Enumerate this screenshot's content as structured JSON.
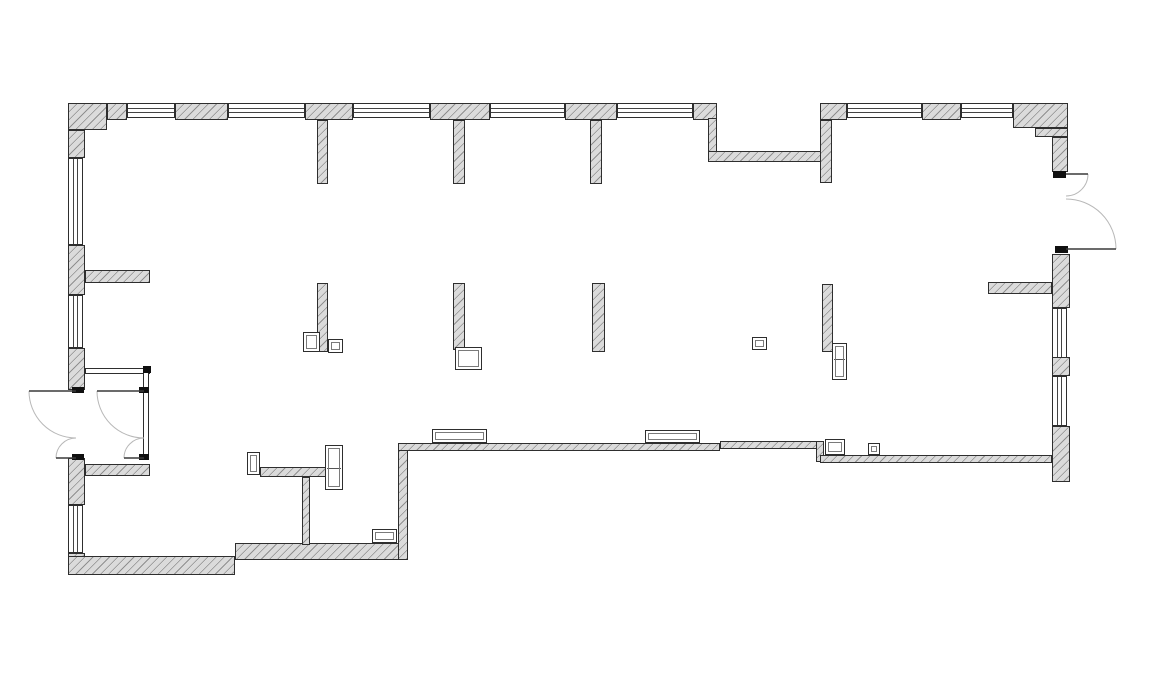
{
  "canvas": {
    "width": 1153,
    "height": 678,
    "background": "#ffffff"
  },
  "drawing_type": "architectural-floor-plan",
  "colors": {
    "background": "#ffffff",
    "wall_fill": "#dbdbdb",
    "wall_hatch": "#8f8f8f",
    "wall_outline": "#2e2e2e",
    "window_glass_line": "#444444",
    "door_swing_arc": "#b8b8b8",
    "door_leaf": "#3a3a3a",
    "door_hinge": "#101010"
  },
  "plan": {
    "walls": [
      {
        "x": 68,
        "y": 103,
        "w": 39,
        "h": 27
      },
      {
        "x": 68,
        "y": 130,
        "w": 17,
        "h": 28
      },
      {
        "x": 107,
        "y": 103,
        "w": 20,
        "h": 17
      },
      {
        "x": 175,
        "y": 103,
        "w": 53,
        "h": 17
      },
      {
        "x": 305,
        "y": 103,
        "w": 48,
        "h": 17
      },
      {
        "x": 317,
        "y": 120,
        "w": 11,
        "h": 64
      },
      {
        "x": 430,
        "y": 103,
        "w": 60,
        "h": 17
      },
      {
        "x": 453,
        "y": 120,
        "w": 12,
        "h": 64
      },
      {
        "x": 565,
        "y": 103,
        "w": 52,
        "h": 17
      },
      {
        "x": 590,
        "y": 120,
        "w": 12,
        "h": 64
      },
      {
        "x": 693,
        "y": 103,
        "w": 24,
        "h": 17
      },
      {
        "x": 708,
        "y": 118,
        "w": 9,
        "h": 40
      },
      {
        "x": 708,
        "y": 151,
        "w": 114,
        "h": 11
      },
      {
        "x": 820,
        "y": 103,
        "w": 27,
        "h": 17
      },
      {
        "x": 820,
        "y": 120,
        "w": 12,
        "h": 63
      },
      {
        "x": 922,
        "y": 103,
        "w": 39,
        "h": 17
      },
      {
        "x": 1013,
        "y": 103,
        "w": 55,
        "h": 25
      },
      {
        "x": 1035,
        "y": 128,
        "w": 33,
        "h": 9
      },
      {
        "x": 1052,
        "y": 137,
        "w": 16,
        "h": 35
      },
      {
        "x": 1052,
        "y": 254,
        "w": 18,
        "h": 54
      },
      {
        "x": 988,
        "y": 282,
        "w": 64,
        "h": 12
      },
      {
        "x": 1052,
        "y": 357,
        "w": 18,
        "h": 19
      },
      {
        "x": 1052,
        "y": 426,
        "w": 18,
        "h": 56
      },
      {
        "x": 68,
        "y": 245,
        "w": 17,
        "h": 50
      },
      {
        "x": 85,
        "y": 270,
        "w": 65,
        "h": 13
      },
      {
        "x": 68,
        "y": 348,
        "w": 17,
        "h": 42
      },
      {
        "x": 68,
        "y": 458,
        "w": 17,
        "h": 47
      },
      {
        "x": 85,
        "y": 464,
        "w": 65,
        "h": 12
      },
      {
        "x": 68,
        "y": 553,
        "w": 17,
        "h": 22
      },
      {
        "x": 68,
        "y": 556,
        "w": 167,
        "h": 19
      },
      {
        "x": 235,
        "y": 543,
        "w": 165,
        "h": 17
      },
      {
        "x": 398,
        "y": 443,
        "w": 10,
        "h": 117
      },
      {
        "x": 398,
        "y": 443,
        "w": 322,
        "h": 8
      },
      {
        "x": 720,
        "y": 441,
        "w": 98,
        "h": 8
      },
      {
        "x": 816,
        "y": 441,
        "w": 8,
        "h": 21
      },
      {
        "x": 820,
        "y": 455,
        "w": 232,
        "h": 8
      },
      {
        "x": 302,
        "y": 477,
        "w": 8,
        "h": 68
      },
      {
        "x": 260,
        "y": 467,
        "w": 70,
        "h": 10
      },
      {
        "x": 317,
        "y": 283,
        "w": 11,
        "h": 69
      },
      {
        "x": 453,
        "y": 283,
        "w": 12,
        "h": 67
      },
      {
        "x": 592,
        "y": 283,
        "w": 13,
        "h": 69
      },
      {
        "x": 822,
        "y": 284,
        "w": 11,
        "h": 68
      }
    ],
    "windows": [
      {
        "x": 127,
        "y": 103,
        "w": 48,
        "h": 15,
        "o": "h"
      },
      {
        "x": 228,
        "y": 103,
        "w": 77,
        "h": 15,
        "o": "h"
      },
      {
        "x": 353,
        "y": 103,
        "w": 77,
        "h": 15,
        "o": "h"
      },
      {
        "x": 490,
        "y": 103,
        "w": 75,
        "h": 15,
        "o": "h"
      },
      {
        "x": 617,
        "y": 103,
        "w": 76,
        "h": 15,
        "o": "h"
      },
      {
        "x": 847,
        "y": 103,
        "w": 75,
        "h": 15,
        "o": "h"
      },
      {
        "x": 961,
        "y": 103,
        "w": 52,
        "h": 15,
        "o": "h"
      },
      {
        "x": 68,
        "y": 158,
        "w": 15,
        "h": 87,
        "o": "v"
      },
      {
        "x": 68,
        "y": 295,
        "w": 15,
        "h": 53,
        "o": "v"
      },
      {
        "x": 68,
        "y": 505,
        "w": 15,
        "h": 48,
        "o": "v"
      },
      {
        "x": 1052,
        "y": 308,
        "w": 15,
        "h": 50,
        "o": "v"
      },
      {
        "x": 1052,
        "y": 376,
        "w": 15,
        "h": 50,
        "o": "v"
      }
    ],
    "partitions": [
      {
        "x": 85,
        "y": 368,
        "w": 65,
        "h": 6
      },
      {
        "x": 143,
        "y": 368,
        "w": 6,
        "h": 92
      }
    ],
    "fixtures": [
      {
        "x": 303,
        "y": 332,
        "w": 17,
        "h": 20
      },
      {
        "x": 328,
        "y": 339,
        "w": 15,
        "h": 14
      },
      {
        "x": 455,
        "y": 347,
        "w": 27,
        "h": 23
      },
      {
        "x": 752,
        "y": 337,
        "w": 15,
        "h": 13
      },
      {
        "x": 832,
        "y": 343,
        "w": 15,
        "h": 37,
        "divider": 358
      },
      {
        "x": 432,
        "y": 429,
        "w": 55,
        "h": 14
      },
      {
        "x": 645,
        "y": 430,
        "w": 55,
        "h": 13
      },
      {
        "x": 825,
        "y": 439,
        "w": 20,
        "h": 16
      },
      {
        "x": 868,
        "y": 443,
        "w": 12,
        "h": 12
      },
      {
        "x": 372,
        "y": 529,
        "w": 25,
        "h": 14
      },
      {
        "x": 247,
        "y": 452,
        "w": 13,
        "h": 23
      },
      {
        "x": 325,
        "y": 445,
        "w": 18,
        "h": 45,
        "divider": 467
      }
    ],
    "hinges": [
      {
        "x": 72,
        "y": 387,
        "w": 12,
        "h": 6
      },
      {
        "x": 72,
        "y": 454,
        "w": 12,
        "h": 6
      },
      {
        "x": 139,
        "y": 387,
        "w": 10,
        "h": 6
      },
      {
        "x": 139,
        "y": 454,
        "w": 10,
        "h": 6
      },
      {
        "x": 143,
        "y": 366,
        "w": 8,
        "h": 7
      },
      {
        "x": 1053,
        "y": 171,
        "w": 13,
        "h": 7
      },
      {
        "x": 1055,
        "y": 246,
        "w": 13,
        "h": 7
      }
    ],
    "doors": [
      {
        "line": [
          76,
          391,
          29,
          391
        ],
        "arc": "M 29 391 A 47 47 0 0 0 76 438"
      },
      {
        "line": [
          76,
          458,
          56,
          458
        ],
        "arc": "M 56 458 A 20 20 0 0 1 76 438"
      },
      {
        "line": [
          144,
          391,
          97,
          391
        ],
        "arc": "M 97 391 A 47 47 0 0 0 144 438"
      },
      {
        "line": [
          144,
          458,
          124,
          458
        ],
        "arc": "M 124 458 A 20 20 0 0 1 144 438"
      },
      {
        "line": [
          1066,
          174,
          1088,
          174
        ],
        "arc": "M 1088 174 A 22 22 0 0 1 1066 196"
      },
      {
        "line": [
          1066,
          249,
          1116,
          249
        ],
        "arc": "M 1116 249 A 50 50 0 0 0 1066 199"
      }
    ]
  }
}
